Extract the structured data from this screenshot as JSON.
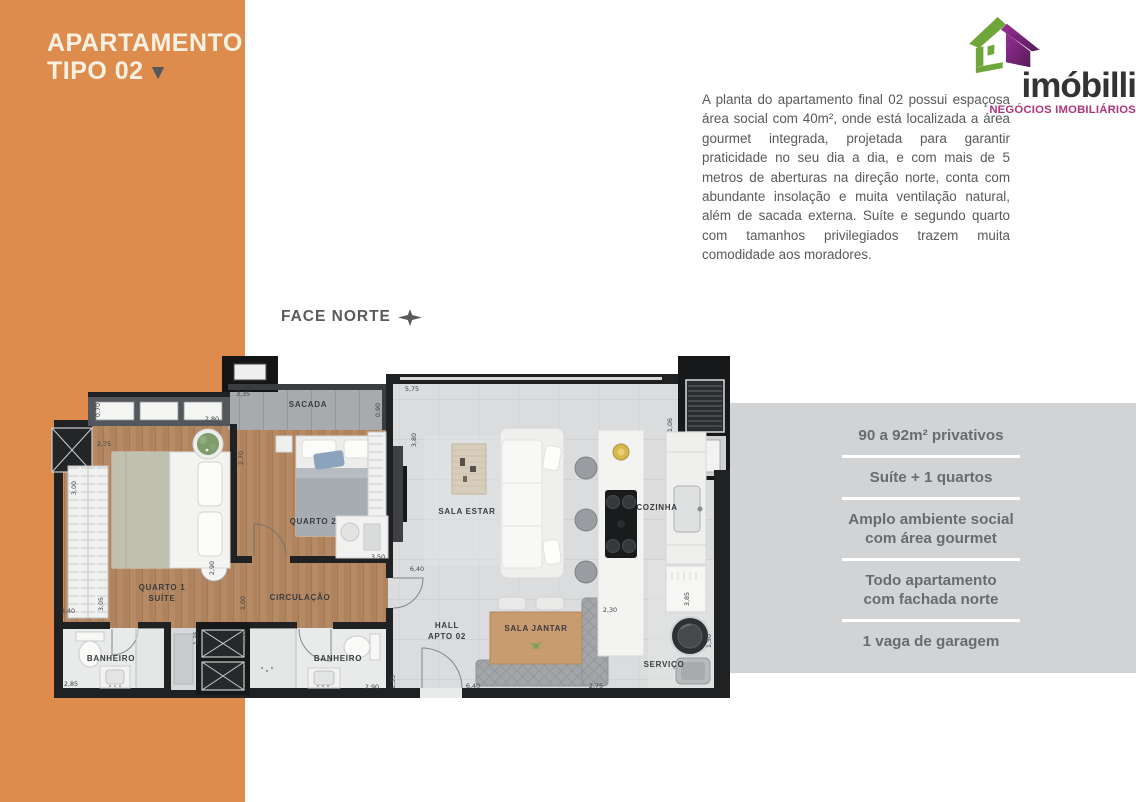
{
  "sidebar": {
    "title_line1": "APARTAMENTO",
    "title_line2": "TIPO 02",
    "title_marker": "▼",
    "accent_color": "#DE8C4D"
  },
  "logo": {
    "name": "imóbilli",
    "tagline": "NEGÓCIOS IMOBILIÁRIOS",
    "house_green": "#6FA63C",
    "house_purple": "#8E2B8C",
    "tagline_color": "#B03478"
  },
  "description": "A planta do apartamento final 02 possui espaçosa área social com 40m², onde está localizada a área gourmet integrada, projetada para garantir praticidade no seu dia a dia, e com mais de 5 metros de aberturas na direção norte, conta com abundante insolação e muita ventilação natural, além de sacada externa. Suíte e segundo quarto com tamanhos privilegiados trazem muita comodidade aos moradores.",
  "orientation_label": "FACE NORTE",
  "features": {
    "panel_color": "#D2D3D4",
    "items": [
      "90 a 92m² privativos",
      "Suíte + 1 quartos",
      "Amplo ambiente social\ncom área gourmet",
      "Todo apartamento\ncom fachada norte",
      "1 vaga de garagem"
    ]
  },
  "floorplan": {
    "room_labels": [
      {
        "t": "SACADA",
        "x": 308,
        "y": 407
      },
      {
        "t": "QUARTO 1",
        "x": 162,
        "y": 590
      },
      {
        "t": "SUÍTE",
        "x": 162,
        "y": 601
      },
      {
        "t": "QUARTO 2",
        "x": 313,
        "y": 524
      },
      {
        "t": "CIRCULAÇÃO",
        "x": 300,
        "y": 600
      },
      {
        "t": "SALA ESTAR",
        "x": 467,
        "y": 514
      },
      {
        "t": "SALA JANTAR",
        "x": 536,
        "y": 631
      },
      {
        "t": "COZINHA",
        "x": 657,
        "y": 510
      },
      {
        "t": "HALL",
        "x": 447,
        "y": 628
      },
      {
        "t": "APTO 02",
        "x": 447,
        "y": 639
      },
      {
        "t": "SERVIÇO",
        "x": 664,
        "y": 667
      },
      {
        "t": "BANHEIRO",
        "x": 111,
        "y": 661
      },
      {
        "t": "BANHEIRO",
        "x": 338,
        "y": 661
      }
    ],
    "dimensions": [
      {
        "t": "0,70",
        "x": 100,
        "y": 410,
        "r": 90
      },
      {
        "t": "2,80",
        "x": 212,
        "y": 421
      },
      {
        "t": "3,35",
        "x": 243,
        "y": 396
      },
      {
        "t": "0,90",
        "x": 380,
        "y": 410,
        "r": 90
      },
      {
        "t": "5,75",
        "x": 412,
        "y": 391
      },
      {
        "t": "1,06",
        "x": 672,
        "y": 425,
        "r": 90
      },
      {
        "t": "2,75",
        "x": 104,
        "y": 446
      },
      {
        "t": "2,70",
        "x": 243,
        "y": 458,
        "r": 90
      },
      {
        "t": "3,00",
        "x": 76,
        "y": 488,
        "r": 90
      },
      {
        "t": "3,40",
        "x": 68,
        "y": 613
      },
      {
        "t": "3,05",
        "x": 103,
        "y": 604,
        "r": 90
      },
      {
        "t": "2,90",
        "x": 214,
        "y": 568,
        "r": 90
      },
      {
        "t": "3,50",
        "x": 378,
        "y": 559
      },
      {
        "t": "3,80",
        "x": 416,
        "y": 440,
        "r": 90
      },
      {
        "t": "6,40",
        "x": 417,
        "y": 571
      },
      {
        "t": "1,00",
        "x": 245,
        "y": 603,
        "r": 90
      },
      {
        "t": "1,35",
        "x": 198,
        "y": 638,
        "r": 90
      },
      {
        "t": "1,35",
        "x": 246,
        "y": 637,
        "r": 90
      },
      {
        "t": "2,85",
        "x": 71,
        "y": 686
      },
      {
        "t": "2,90",
        "x": 372,
        "y": 689
      },
      {
        "t": "1,35",
        "x": 395,
        "y": 682,
        "r": 90
      },
      {
        "t": "6,40",
        "x": 473,
        "y": 688
      },
      {
        "t": "2,75",
        "x": 596,
        "y": 688
      },
      {
        "t": "2,30",
        "x": 610,
        "y": 612
      },
      {
        "t": "3,85",
        "x": 689,
        "y": 599,
        "r": 90
      },
      {
        "t": "1,50",
        "x": 711,
        "y": 641,
        "r": 90
      }
    ]
  }
}
